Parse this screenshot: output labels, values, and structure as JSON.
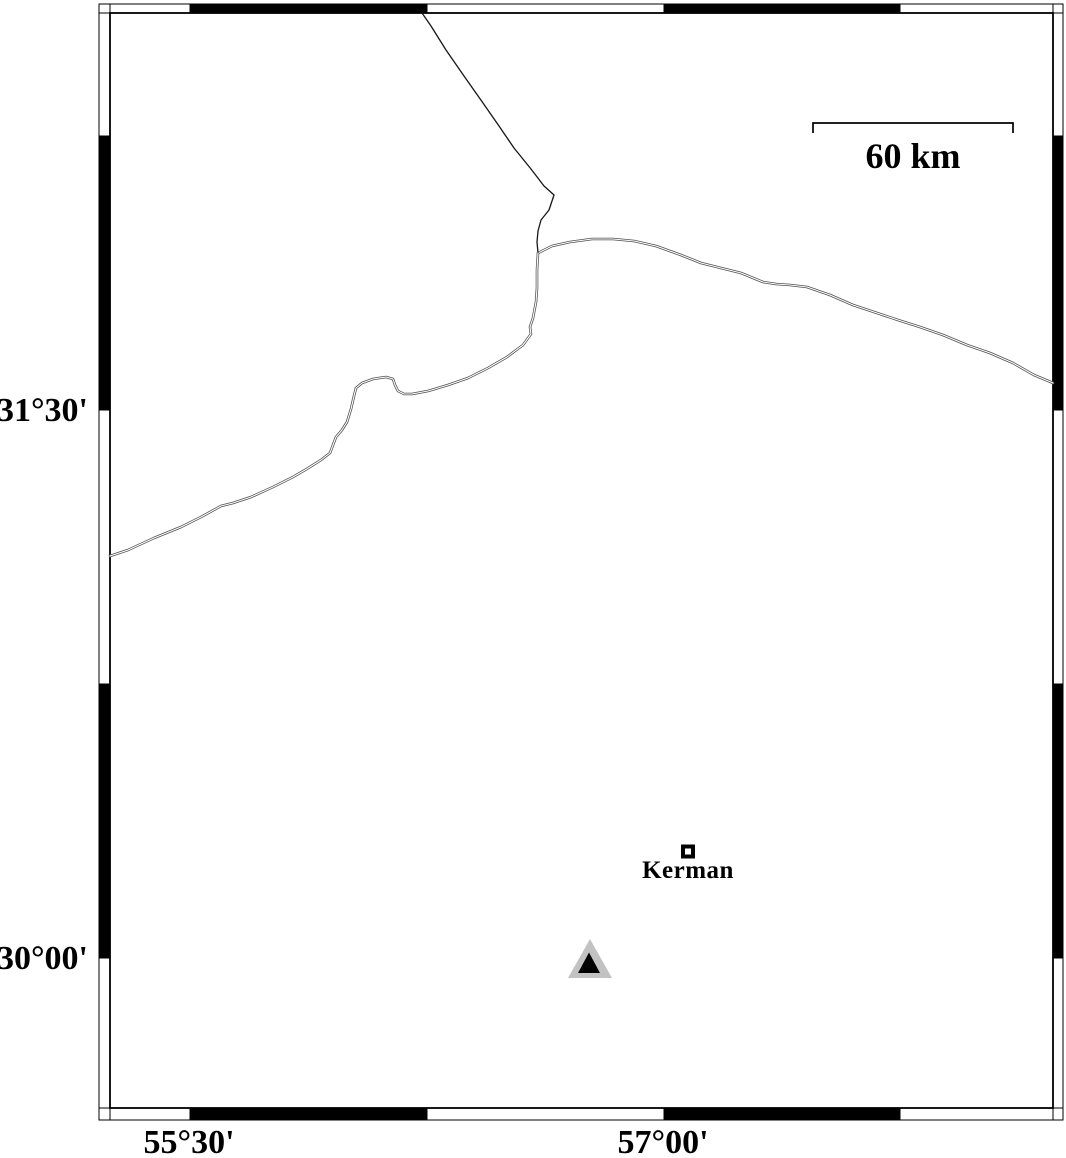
{
  "figure": {
    "type": "map",
    "background": "#ffffff",
    "colors": {
      "frame_fill_a": "#ffffff",
      "frame_fill_b": "#000000",
      "boundary_line": "#161616",
      "road_casing": "#4f4f4f",
      "road_core": "#ffffff",
      "station_outer": "#c2c2c2",
      "station_inner": "#000000"
    },
    "axis_annotations": {
      "left": [
        {
          "label": "31°30'",
          "tick_y": 410
        },
        {
          "label": "30°00'",
          "tick_y": 958
        }
      ],
      "bottom": [
        {
          "label": "55°30'",
          "tick_x": 189
        },
        {
          "label": "57°00'",
          "tick_x": 663
        }
      ]
    },
    "frame": {
      "outer": [
        99,
        4,
        1063,
        1120
      ],
      "inner": [
        110,
        13,
        1053,
        1108
      ],
      "h_boundaries": [
        99,
        190,
        427,
        664,
        900,
        1063
      ],
      "v_boundaries": [
        4,
        136,
        410,
        684,
        958,
        1120
      ]
    },
    "scale_bar": {
      "label": "60 km",
      "x1": 813,
      "x2": 1013,
      "y": 123,
      "tick_drop": 10
    },
    "city": {
      "name": "Kerman",
      "x": 688,
      "y": 851.5,
      "size": 14
    },
    "station": {
      "outer_points": [
        [
          590,
          939
        ],
        [
          568,
          978
        ],
        [
          612,
          978
        ]
      ],
      "inner_points": [
        [
          589,
          952.5
        ],
        [
          578,
          973
        ],
        [
          600,
          973
        ]
      ]
    },
    "lines": [
      {
        "name": "boundary-line",
        "style": "single",
        "points": [
          [
            422,
            13
          ],
          [
            431,
            26
          ],
          [
            446,
            50
          ],
          [
            464,
            76
          ],
          [
            483,
            103
          ],
          [
            499,
            126
          ],
          [
            514,
            148
          ],
          [
            531,
            169
          ],
          [
            544,
            186
          ],
          [
            554,
            195
          ],
          [
            549,
            210
          ],
          [
            541,
            220
          ],
          [
            538,
            231
          ],
          [
            537,
            242
          ],
          [
            538,
            253
          ]
        ]
      },
      {
        "name": "road-east",
        "style": "double",
        "points": [
          [
            538,
            253
          ],
          [
            552,
            246
          ],
          [
            570,
            242
          ],
          [
            592,
            239
          ],
          [
            613,
            239
          ],
          [
            634,
            241
          ],
          [
            656,
            246
          ],
          [
            681,
            255
          ],
          [
            701,
            263
          ],
          [
            721,
            268
          ],
          [
            741,
            273
          ],
          [
            763,
            282
          ],
          [
            776,
            284
          ],
          [
            790,
            285
          ],
          [
            807,
            287
          ],
          [
            830,
            295
          ],
          [
            853,
            305
          ],
          [
            877,
            313
          ],
          [
            898,
            320
          ],
          [
            920,
            327
          ],
          [
            943,
            335
          ],
          [
            967,
            345
          ],
          [
            990,
            353
          ],
          [
            1013,
            363
          ],
          [
            1034,
            375
          ],
          [
            1053,
            383
          ]
        ]
      },
      {
        "name": "road-southwest",
        "style": "double",
        "points": [
          [
            538,
            253
          ],
          [
            537,
            270
          ],
          [
            537,
            288
          ],
          [
            536,
            302
          ],
          [
            533,
            318
          ],
          [
            530,
            327
          ],
          [
            531,
            334
          ],
          [
            523,
            345
          ],
          [
            507,
            357
          ],
          [
            488,
            368
          ],
          [
            468,
            378
          ],
          [
            448,
            385
          ],
          [
            428,
            391
          ],
          [
            412,
            394
          ],
          [
            404,
            394
          ],
          [
            398,
            391
          ],
          [
            395,
            385
          ],
          [
            393,
            379
          ],
          [
            386,
            377
          ],
          [
            373,
            379
          ],
          [
            362,
            383
          ],
          [
            356,
            388
          ],
          [
            354,
            396
          ],
          [
            351,
            409
          ],
          [
            347,
            422
          ],
          [
            342,
            430
          ],
          [
            336,
            437
          ],
          [
            333,
            445
          ],
          [
            330,
            453
          ],
          [
            321,
            460
          ],
          [
            305,
            470
          ],
          [
            293,
            477
          ],
          [
            273,
            487
          ],
          [
            251,
            497
          ],
          [
            233,
            503
          ],
          [
            221,
            506
          ],
          [
            201,
            517
          ],
          [
            181,
            527
          ],
          [
            154,
            538
          ],
          [
            128,
            550
          ],
          [
            110,
            556
          ]
        ]
      }
    ]
  }
}
